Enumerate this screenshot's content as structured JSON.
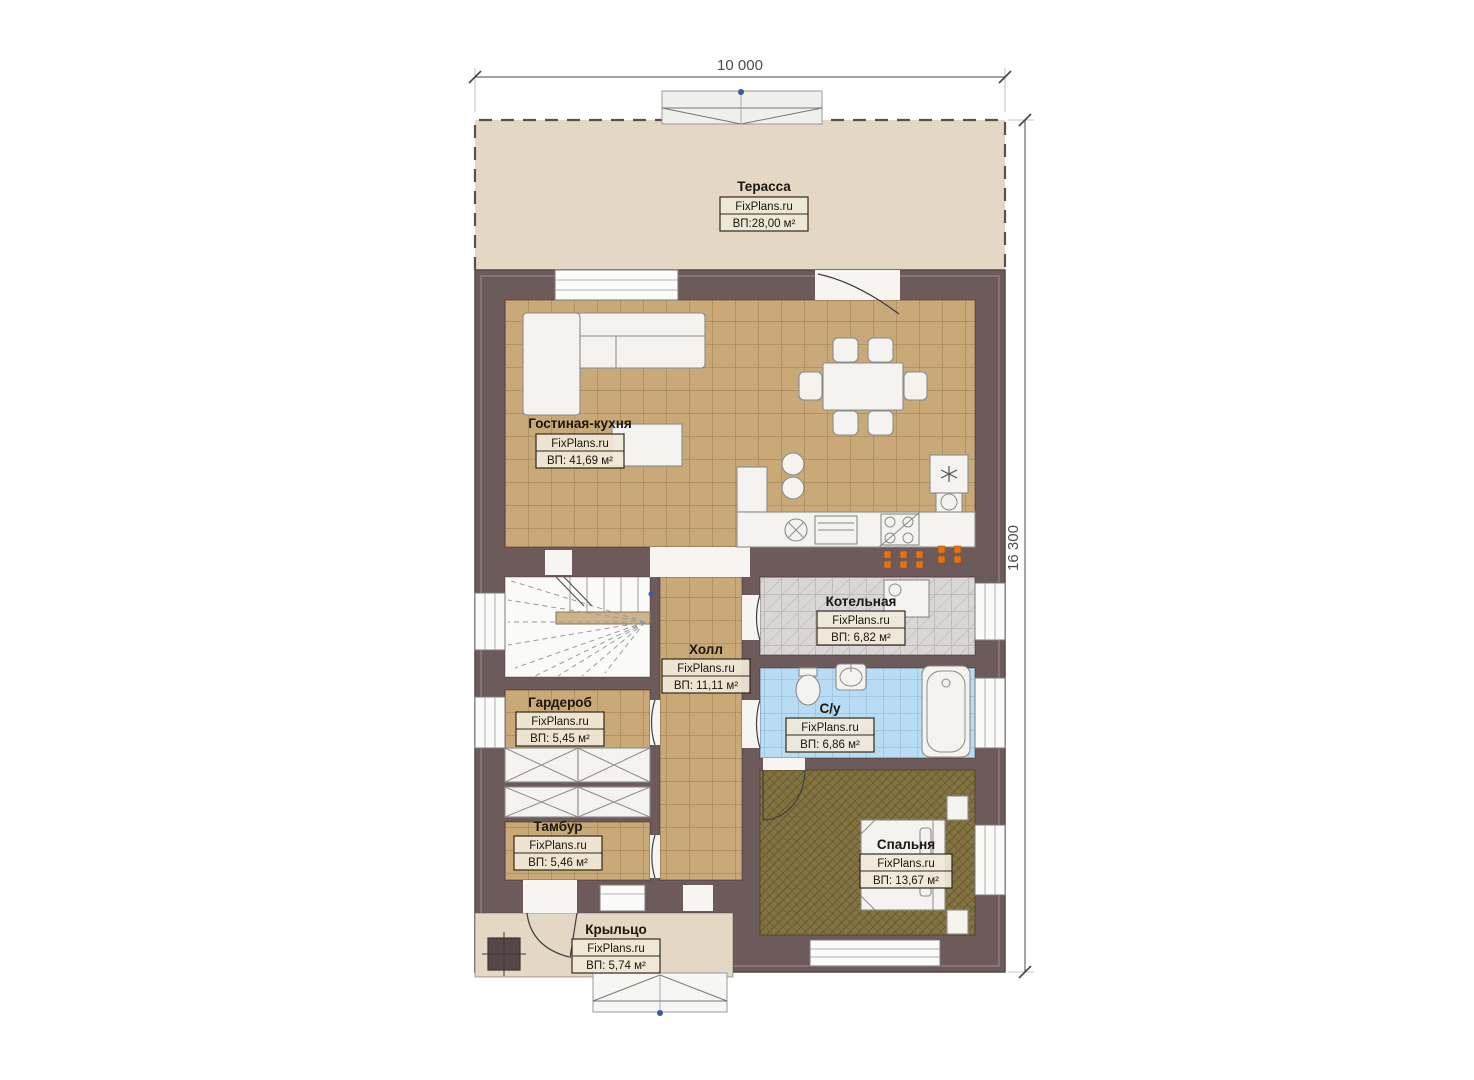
{
  "plan": {
    "brand": "FixPlans.ru",
    "dimensions": {
      "width": "10 000",
      "height": "16 300"
    },
    "rooms": [
      {
        "id": "terrace",
        "name": "Терасса",
        "site": "FixPlans.ru",
        "area": "ВП:28,00 м²"
      },
      {
        "id": "living-kitchen",
        "name": "Гостиная-кухня",
        "site": "FixPlans.ru",
        "area": "ВП: 41,69 м²"
      },
      {
        "id": "boiler",
        "name": "Котельная",
        "site": "FixPlans.ru",
        "area": "ВП: 6,82 м²"
      },
      {
        "id": "hall",
        "name": "Холл",
        "site": "FixPlans.ru",
        "area": "ВП: 11,11 м²"
      },
      {
        "id": "bathroom",
        "name": "С/у",
        "site": "FixPlans.ru",
        "area": "ВП: 6,86 м²"
      },
      {
        "id": "wardrobe",
        "name": "Гардероб",
        "site": "FixPlans.ru",
        "area": "ВП: 5,45 м²"
      },
      {
        "id": "vestibule",
        "name": "Тамбур",
        "site": "FixPlans.ru",
        "area": "ВП: 5,46 м²"
      },
      {
        "id": "bedroom",
        "name": "Спальня",
        "site": "FixPlans.ru",
        "area": "ВП: 13,67 м²"
      },
      {
        "id": "porch",
        "name": "Крыльцо",
        "site": "FixPlans.ru",
        "area": "ВП: 5,74 м²"
      }
    ],
    "colors": {
      "wall": "#6d5a5a",
      "terrace_floor": "#e4d7c3",
      "tile_tan": "#c9a977",
      "tile_grout": "#9a7f52",
      "tile_gray": "#d8d7d5",
      "tile_blue": "#b9dcf5",
      "carpet_brown": "#847342",
      "furniture_white": "#f4f3ef",
      "socket_orange": "#e0731d",
      "marker_blue": "#3a5ba0",
      "dimension_gray": "#4d4d4d"
    }
  }
}
